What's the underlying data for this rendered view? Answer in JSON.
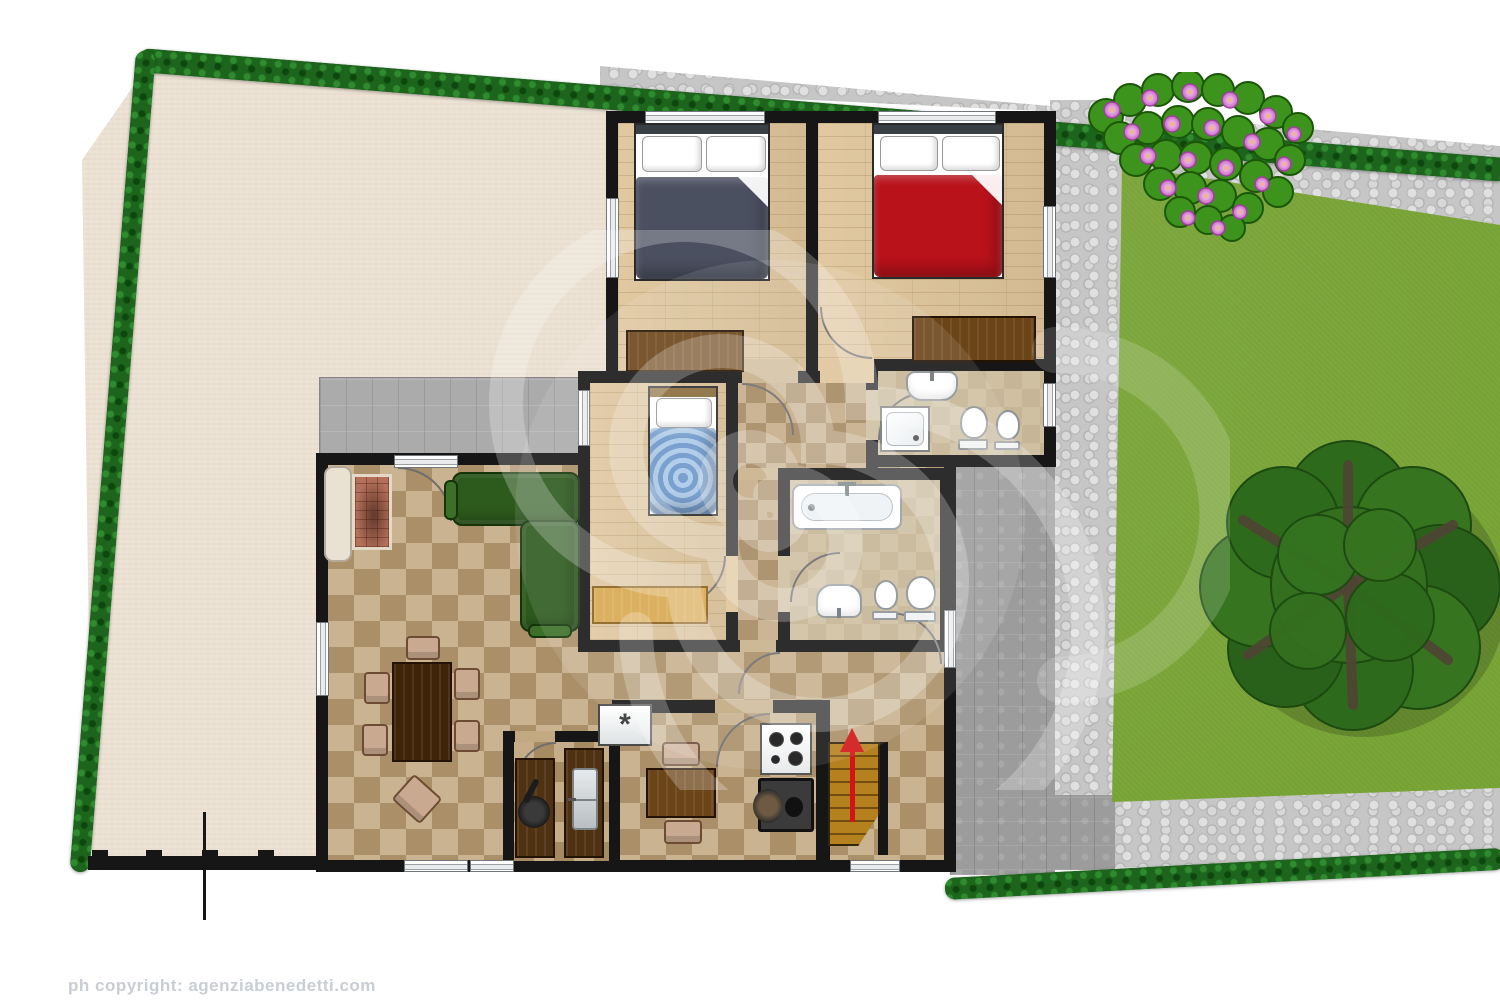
{
  "copyright": "ph copyright: agenziabenedetti.com",
  "symbols": {
    "kitchen_appliance": "*",
    "stairs_arrow_direction": "up"
  },
  "palette": {
    "yard_beige": "#ece2d4",
    "lawn_green": "#7aa637",
    "hedge_green": "#1d651d",
    "cobble_gray": "#c6c6c6",
    "patio_gray": "#9c9c9c",
    "terrace_gray": "#ababab",
    "wall_black": "#161616",
    "parquet_wood": "#dec49a",
    "tile_tan": "#c2a981",
    "bath_floor": "#cfc0a2",
    "bed_gray_duvet": "#4b5060",
    "bed_red_duvet": "#b9121b",
    "bed_blue_duvet": "#8fb7e0",
    "sofa_green": "#2d5a1d",
    "wood_dark": "#3f2408",
    "wood_mid": "#6b4418",
    "wood_light": "#d9a850",
    "counter_brown": "#4f3212",
    "stairs_wood": "#b5811f",
    "arrow_red": "#d21414",
    "chair_tan": "#c9a98f",
    "flower_pink": "#d684d6",
    "tree_green": "#2e671c",
    "cream_sofa": "#e9e2d2",
    "fireplace_brick": "#b5705a"
  },
  "scene": {
    "type": "residential floor plan with garden, top-down view",
    "outdoor": [
      {
        "id": "yard",
        "surface": "bare beige ground"
      },
      {
        "id": "lawn",
        "surface": "grass with large tree"
      },
      {
        "id": "flower-bed",
        "detail": "pink flowering shrubs"
      },
      {
        "id": "hedges",
        "detail": "dark green hedge on top, left and bottom-right borders"
      },
      {
        "id": "cobblestone-path",
        "detail": "wraps top and right of house"
      },
      {
        "id": "patio",
        "detail": "gray tiled area right of house"
      },
      {
        "id": "terrace",
        "detail": "gray tiled area above living room"
      },
      {
        "id": "fence",
        "detail": "black boundary wall with posts and gate mark, bottom left"
      }
    ],
    "rooms": [
      {
        "id": "bedroom-1",
        "furniture": [
          "double-bed-gray",
          "wardrobe"
        ]
      },
      {
        "id": "bedroom-2",
        "furniture": [
          "double-bed-red",
          "dresser"
        ]
      },
      {
        "id": "bedroom-3",
        "furniture": [
          "single-bed-blue",
          "desk"
        ]
      },
      {
        "id": "bathroom-1",
        "fixtures": [
          "washbasin",
          "shower",
          "toilet",
          "bidet"
        ]
      },
      {
        "id": "bathroom-2",
        "fixtures": [
          "bathtub",
          "washbasin",
          "bidet",
          "toilet"
        ]
      },
      {
        "id": "living-dining-room",
        "furniture": [
          "fireplace",
          "cream-sofa",
          "green-corner-sofa",
          "dining-table",
          "six-chairs",
          "side-chair"
        ]
      },
      {
        "id": "kitchen",
        "furniture": [
          "appliance-with-asterisk",
          "small-table",
          "two-chairs",
          "gas-hob",
          "wood-stove"
        ]
      },
      {
        "id": "pantry",
        "furniture": [
          "counter-with-pan",
          "double-sink-counter"
        ]
      },
      {
        "id": "hallway",
        "surface": "checkered tiles"
      },
      {
        "id": "stairs",
        "detail": "wooden stairs with red up arrow"
      }
    ],
    "watermark": "large translucent white spiral logo over center"
  }
}
